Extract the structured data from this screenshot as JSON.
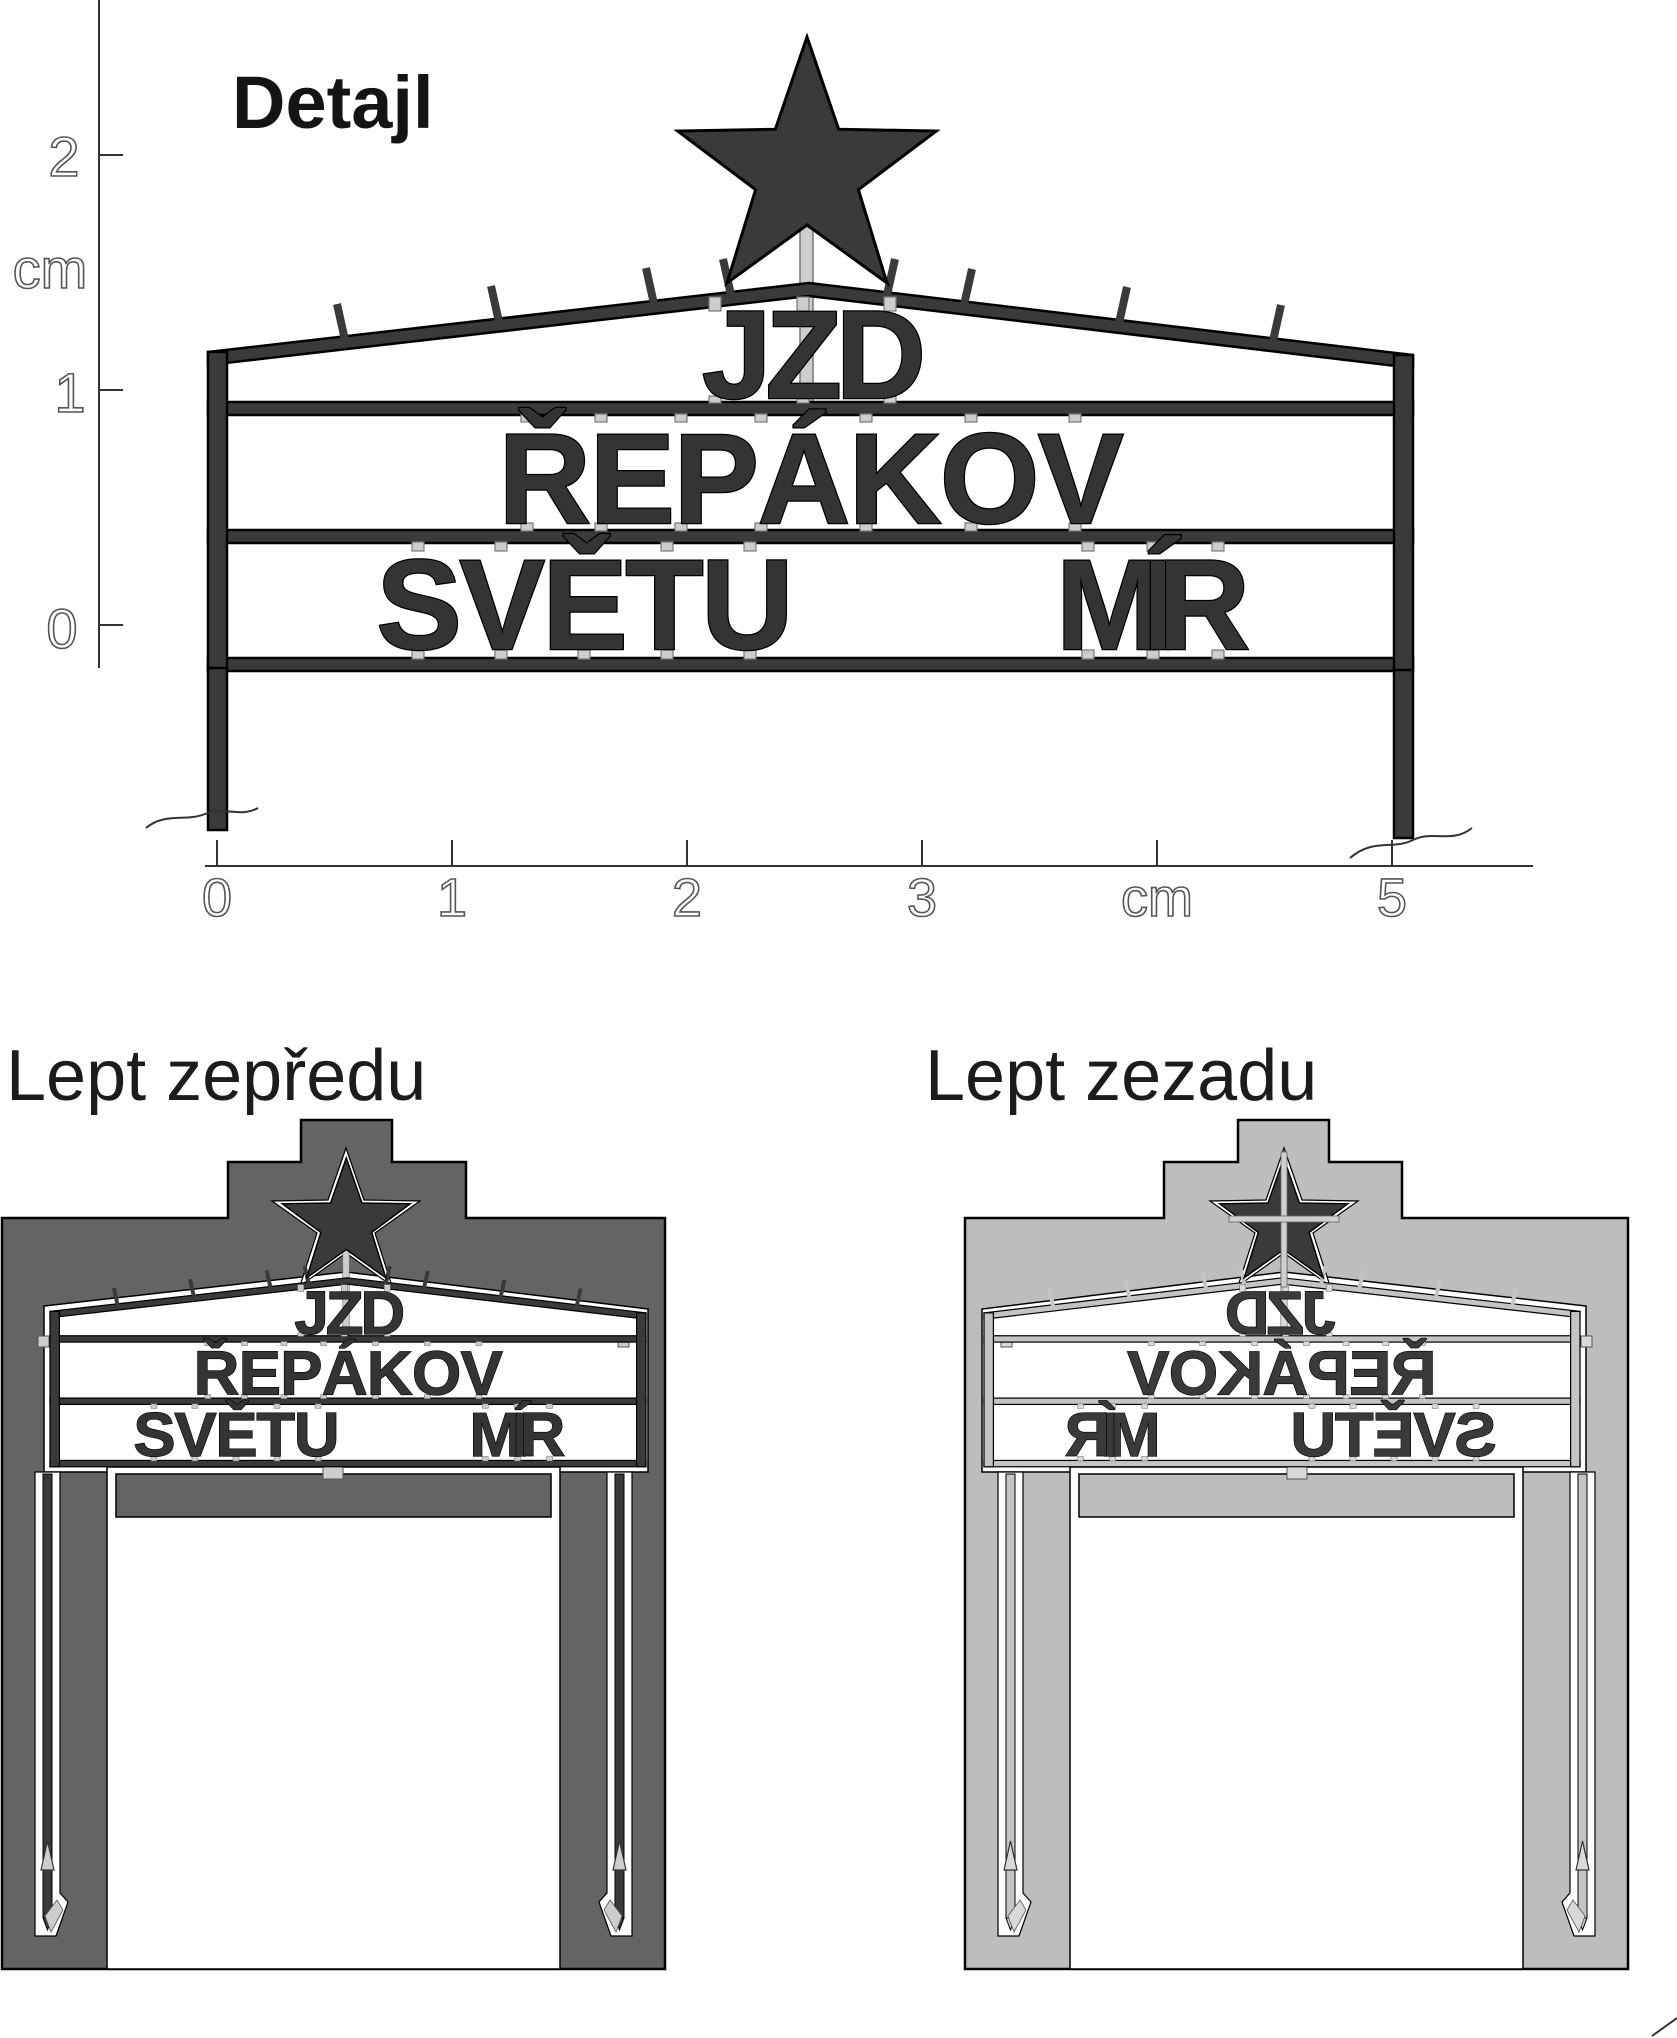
{
  "detail": {
    "title": "Detajl",
    "v_ruler": {
      "labels": [
        "2",
        "cm",
        "1",
        "0"
      ]
    },
    "h_ruler": {
      "labels": [
        "0",
        "1",
        "2",
        "3",
        "cm",
        "5"
      ]
    }
  },
  "sign": {
    "line1": "JZD",
    "line2": "ŘEPÁKOV",
    "line3_left": "SVĚTU",
    "line3_right": "MÍR"
  },
  "etch_front": {
    "title": "Lept zepředu"
  },
  "etch_back": {
    "title": "Lept zezadu"
  },
  "colors": {
    "structure": "#3a3a3a",
    "front_plate": "#646464",
    "back_plate": "#bdbdbd",
    "back_structure": "#c4c4c4",
    "tab": "#cdcdcd",
    "back_tab": "#d9d9d9"
  }
}
